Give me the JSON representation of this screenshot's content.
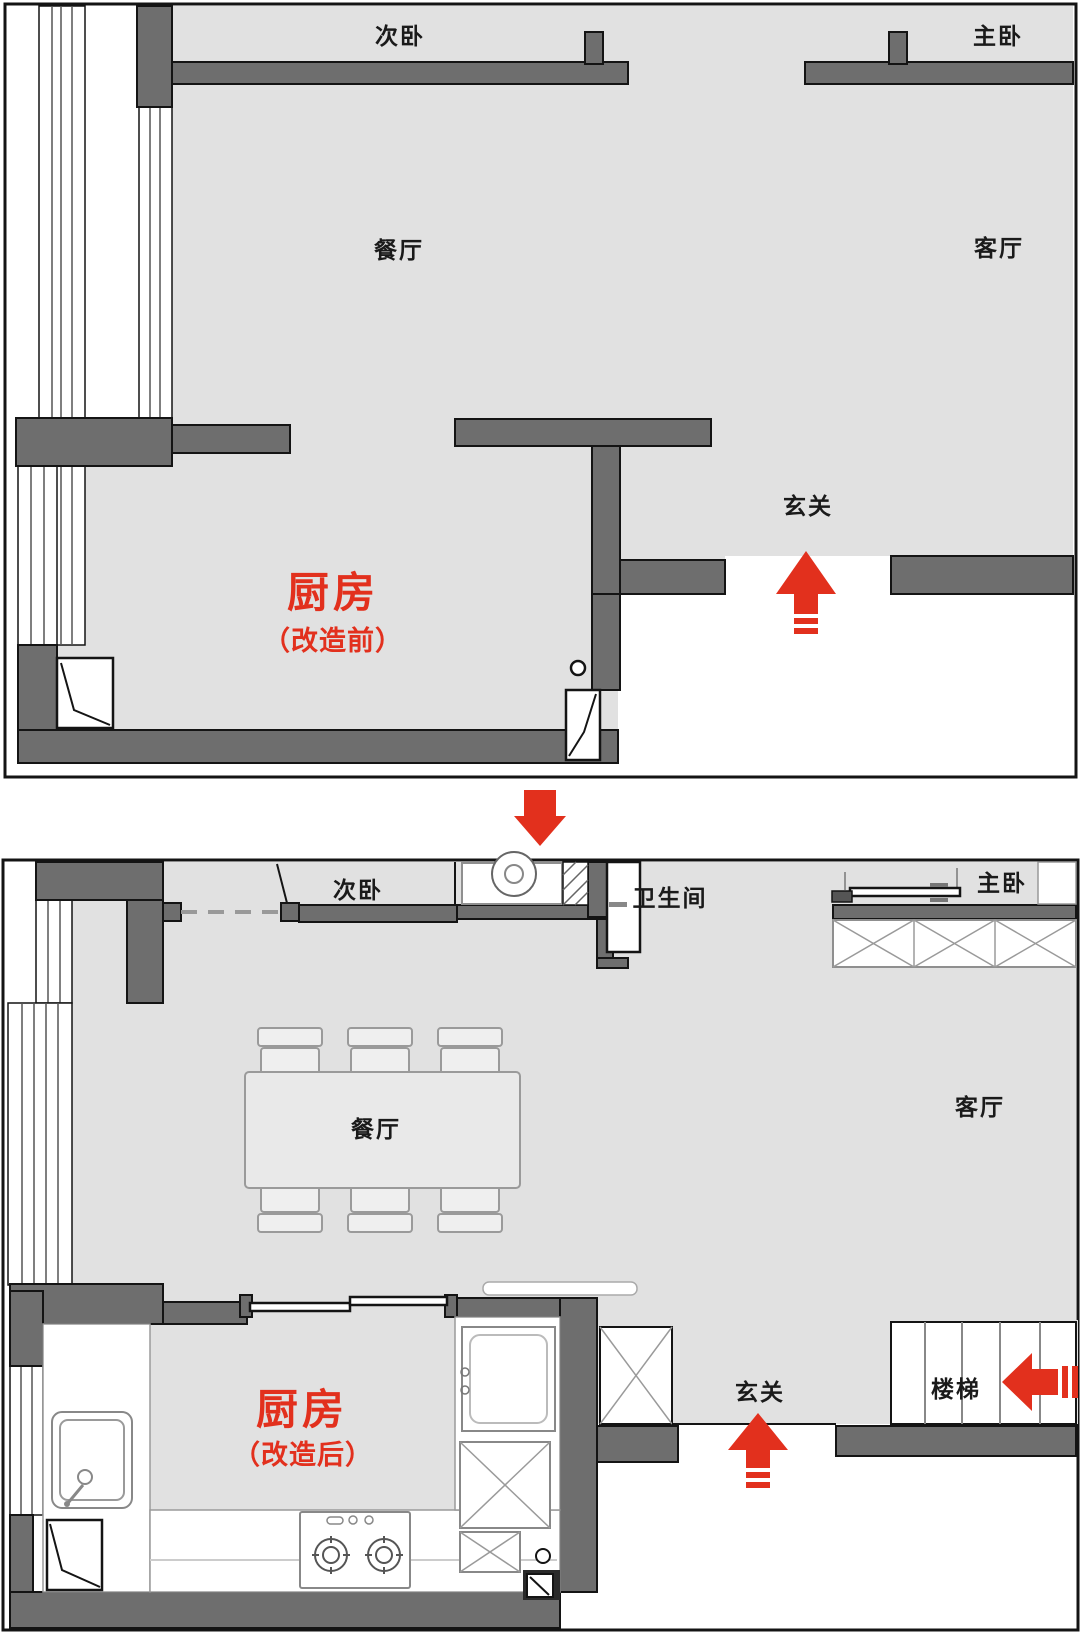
{
  "page": {
    "type": "floor-plan-comparison",
    "background": "#ffffff"
  },
  "colors": {
    "floor": "#e1e1e1",
    "wall": "#6e6e6e",
    "outline": "#141414",
    "accent_red": "#e2301d",
    "furniture_stroke": "#8f8f8f"
  },
  "plans": {
    "before": {
      "rooms": {
        "secondary_bedroom": "次卧",
        "master_bedroom": "主卧",
        "dining": "餐厅",
        "living": "客厅",
        "entry": "玄关"
      },
      "highlight": {
        "kitchen": "厨房",
        "note": "（改造前）"
      }
    },
    "after": {
      "rooms": {
        "secondary_bedroom": "次卧",
        "bathroom": "卫生间",
        "master_bedroom": "主卧",
        "dining": "餐厅",
        "living": "客厅",
        "entry": "玄关",
        "stairs": "楼梯"
      },
      "highlight": {
        "kitchen": "厨房",
        "note": "（改造后）"
      }
    }
  },
  "icons": {
    "transform_arrow": "down-arrow",
    "before_entry_arrow": "up-arrow",
    "after_entry_arrow": "up-arrow",
    "stairs_direction_arrow": "left-arrow",
    "washing_machine": "washing-machine-icon",
    "kitchen_sink": "sink-icon",
    "gas_stove": "stove-icon",
    "dining_table": "dining-table-icon",
    "wardrobe": "wardrobe-x-icon",
    "shoe_cabinet": "cabinet-x-icon",
    "stair_treads": "stairs-icon"
  }
}
